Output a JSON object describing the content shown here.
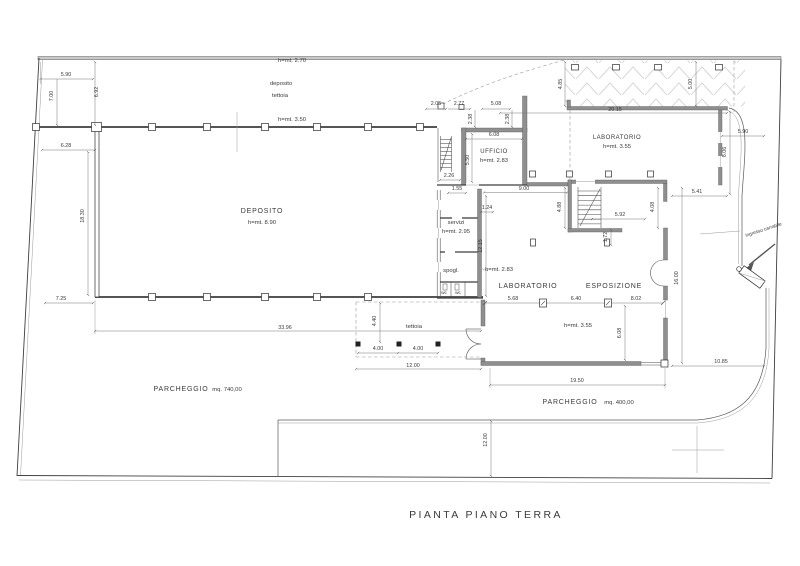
{
  "drawing_title": "PIANTA PIANO TERRA",
  "colors": {
    "paper": "#ffffff",
    "line": "#3f3f3f",
    "wall_fill": "#8f8f8f",
    "dimension_text": "#3a3a3a",
    "hatch": "#cccccc"
  },
  "rooms": [
    {
      "name": "DEPOSITO",
      "height": "h=mt. 8.90"
    },
    {
      "name": "deposito tettoia",
      "height": "h=mt. 2.70"
    },
    {
      "name": "tettoia (retro)",
      "height": "h=mt. 3.50"
    },
    {
      "name": "UFFICIO",
      "height": "h=mt. 2.83"
    },
    {
      "name": "LABORATORIO",
      "height": "h=mt. 3.55"
    },
    {
      "name": "servizi",
      "height": "h=mt. 2.95"
    },
    {
      "name": "spogl.",
      "height": "h=mt. 2.83"
    },
    {
      "name": "LABORATORIO",
      "height": "h=mt. 3.55"
    },
    {
      "name": "ESPOSIZIONE",
      "height": "h=mt. 3.55"
    },
    {
      "name": "PARCHEGGIO",
      "area": "mq. 740,00"
    },
    {
      "name": "PARCHEGGIO",
      "area": "mq. 400,00"
    },
    {
      "name": "ingresso carrabile"
    }
  ],
  "labels": [
    {
      "text": "5.90",
      "x": 66,
      "y": 76,
      "kind": "dim"
    },
    {
      "text": "7.00",
      "x": 53,
      "y": 96,
      "kind": "dim",
      "rot": -90
    },
    {
      "text": "6.92",
      "x": 98,
      "y": 92,
      "kind": "dim",
      "rot": -90
    },
    {
      "text": "6.28",
      "x": 66,
      "y": 147,
      "kind": "dim"
    },
    {
      "text": "18.30",
      "x": 84,
      "y": 216,
      "kind": "dim",
      "rot": -90
    },
    {
      "text": "7.25",
      "x": 61,
      "y": 300,
      "kind": "dim"
    },
    {
      "text": "33.96",
      "x": 285,
      "y": 329,
      "kind": "dim"
    },
    {
      "text": "h=mt. 2.70",
      "x": 292,
      "y": 62,
      "kind": "note"
    },
    {
      "text": "deposito",
      "x": 281,
      "y": 85,
      "kind": "note"
    },
    {
      "text": "tettoia",
      "x": 280,
      "y": 97,
      "kind": "note"
    },
    {
      "text": "h=mt. 3.50",
      "x": 292,
      "y": 121,
      "kind": "note"
    },
    {
      "text": "DEPOSITO",
      "x": 262,
      "y": 213,
      "kind": "room"
    },
    {
      "text": "h=mt. 8.90",
      "x": 262,
      "y": 224,
      "kind": "note"
    },
    {
      "text": "2.05",
      "x": 436,
      "y": 105,
      "kind": "dim"
    },
    {
      "text": "2.77",
      "x": 459,
      "y": 105,
      "kind": "dim"
    },
    {
      "text": "5.08",
      "x": 496,
      "y": 105,
      "kind": "dim"
    },
    {
      "text": "2.38",
      "x": 472,
      "y": 119,
      "kind": "dim",
      "rot": -90
    },
    {
      "text": "2.38",
      "x": 509,
      "y": 119,
      "kind": "dim",
      "rot": -90
    },
    {
      "text": "6.08",
      "x": 494,
      "y": 136,
      "kind": "dim"
    },
    {
      "text": "5.50",
      "x": 469,
      "y": 160,
      "kind": "dim",
      "rot": -90
    },
    {
      "text": "2.26",
      "x": 449,
      "y": 177,
      "kind": "dim"
    },
    {
      "text": "UFFICIO",
      "x": 494,
      "y": 153,
      "kind": "roomsm"
    },
    {
      "text": "h=mt. 2.83",
      "x": 494,
      "y": 162,
      "kind": "note"
    },
    {
      "text": "LABORATORIO",
      "x": 617,
      "y": 139,
      "kind": "roomsm"
    },
    {
      "text": "h=mt. 3.55",
      "x": 617,
      "y": 148,
      "kind": "note"
    },
    {
      "text": "20.15",
      "x": 615,
      "y": 111,
      "kind": "dim"
    },
    {
      "text": "4.85",
      "x": 562,
      "y": 84,
      "kind": "dim",
      "rot": -90
    },
    {
      "text": "5.00",
      "x": 692,
      "y": 84,
      "kind": "dim",
      "rot": -90
    },
    {
      "text": "5.90",
      "x": 743,
      "y": 133,
      "kind": "dim"
    },
    {
      "text": "8.06",
      "x": 726,
      "y": 152,
      "kind": "dim",
      "rot": -90
    },
    {
      "text": "1.55",
      "x": 457,
      "y": 190,
      "kind": "dim"
    },
    {
      "text": "9.00",
      "x": 524,
      "y": 190,
      "kind": "dim"
    },
    {
      "text": "1.24",
      "x": 487,
      "y": 209,
      "kind": "dim"
    },
    {
      "text": "12.15",
      "x": 482,
      "y": 246,
      "kind": "dim",
      "rot": -90
    },
    {
      "text": "servizi",
      "x": 456,
      "y": 224,
      "kind": "note"
    },
    {
      "text": "h=mt. 2.95",
      "x": 456,
      "y": 233,
      "kind": "note"
    },
    {
      "text": "spogl.",
      "x": 451,
      "y": 272,
      "kind": "note"
    },
    {
      "text": "wc",
      "x": 444,
      "y": 294,
      "kind": "tiny"
    },
    {
      "text": "wc",
      "x": 458,
      "y": 294,
      "kind": "tiny"
    },
    {
      "text": "h=mt. 2.83",
      "x": 499,
      "y": 271,
      "kind": "note"
    },
    {
      "text": "4.88",
      "x": 561,
      "y": 207,
      "kind": "dim",
      "rot": -90
    },
    {
      "text": "5.92",
      "x": 620,
      "y": 216,
      "kind": "dim"
    },
    {
      "text": "1.72",
      "x": 607,
      "y": 237,
      "kind": "dim",
      "rot": -90
    },
    {
      "text": "4.08",
      "x": 654,
      "y": 207,
      "kind": "dim",
      "rot": -90
    },
    {
      "text": "5.41",
      "x": 697,
      "y": 193,
      "kind": "dim"
    },
    {
      "text": "16.00",
      "x": 678,
      "y": 278,
      "kind": "dim",
      "rot": -90
    },
    {
      "text": "LABORATORIO",
      "x": 528,
      "y": 288,
      "kind": "room"
    },
    {
      "text": "ESPOSIZIONE",
      "x": 614,
      "y": 288,
      "kind": "room"
    },
    {
      "text": "5.68",
      "x": 513,
      "y": 300,
      "kind": "dim"
    },
    {
      "text": "6.40",
      "x": 576,
      "y": 300,
      "kind": "dim"
    },
    {
      "text": "8.02",
      "x": 636,
      "y": 300,
      "kind": "dim"
    },
    {
      "text": "h=mt. 3.55",
      "x": 578,
      "y": 327,
      "kind": "note"
    },
    {
      "text": "6.08",
      "x": 621,
      "y": 333,
      "kind": "dim",
      "rot": -90
    },
    {
      "text": "tettoia",
      "x": 414,
      "y": 328,
      "kind": "note"
    },
    {
      "text": "4.40",
      "x": 376,
      "y": 321,
      "kind": "dim",
      "rot": -90
    },
    {
      "text": "4.00",
      "x": 378,
      "y": 350,
      "kind": "dim"
    },
    {
      "text": "4.00",
      "x": 418,
      "y": 350,
      "kind": "dim"
    },
    {
      "text": "12.00",
      "x": 413,
      "y": 367,
      "kind": "dim"
    },
    {
      "text": "19.50",
      "x": 577,
      "y": 382,
      "kind": "dim"
    },
    {
      "text": "10.85",
      "x": 721,
      "y": 363,
      "kind": "dim"
    },
    {
      "text": "12.00",
      "x": 487,
      "y": 440,
      "kind": "dim",
      "rot": -90
    },
    {
      "text": "PARCHEGGIO",
      "x": 181,
      "y": 391,
      "kind": "room"
    },
    {
      "text": "mq. 740,00",
      "x": 227,
      "y": 391,
      "kind": "note"
    },
    {
      "text": "PARCHEGGIO",
      "x": 570,
      "y": 404,
      "kind": "room"
    },
    {
      "text": "mq. 400,00",
      "x": 619,
      "y": 404,
      "kind": "note"
    },
    {
      "text": "ingresso carrabile",
      "x": 764,
      "y": 231,
      "kind": "tiny",
      "rot": -18
    }
  ]
}
